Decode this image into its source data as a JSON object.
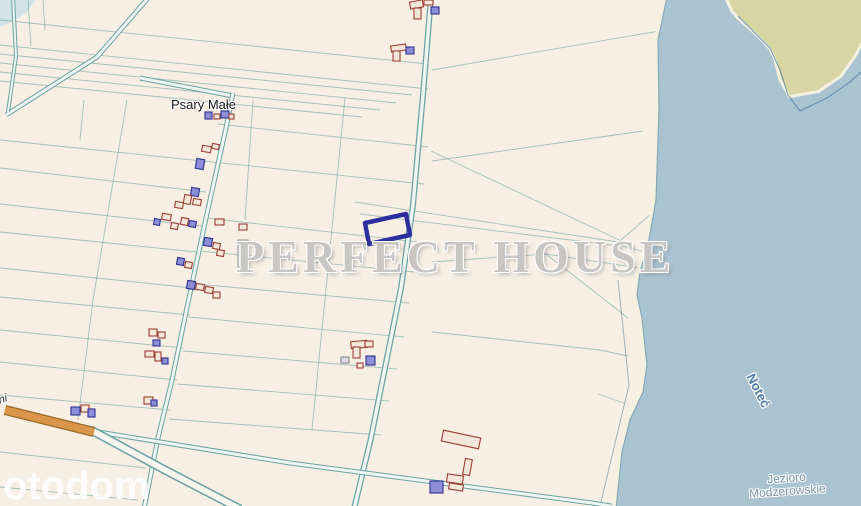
{
  "map": {
    "place_label": "Psary Małe",
    "river_label": "Noteć",
    "lake_label_line1": "Jezioro",
    "lake_label_line2": "Modzerowskie",
    "watermark": "PERFECT HOUSE",
    "brand_logo": "otodom",
    "edge_label": "ni"
  },
  "colors": {
    "land": "#f7efe3",
    "water": "#aac3d0",
    "island": "#d8d4a4",
    "beach": "#f4f1e0",
    "shoreline": "#85a8b5",
    "pond": "#cfe3e8",
    "parcel_line": "#5c9b9b",
    "parcel_line_gray": "#7a93a3",
    "road_casing": "#6aa3a3",
    "road_fill": "#eef4f0",
    "orange_road": "#d9964a",
    "orange_road_edge": "#9a6a2a",
    "building_outline": "#9c3d33",
    "building_fill": "#f3e7da",
    "building_blue_outline": "#2e3192",
    "building_blue_fill": "#8d8fd6",
    "highlight_plot": "#2c2f9f",
    "place_label_color": "#1a1a1a",
    "river_label_color": "#4d7ba3",
    "lake_label_color": "#7e94a6",
    "watermark_color": "#c8c6c3",
    "brand_color": "#ffffff"
  }
}
